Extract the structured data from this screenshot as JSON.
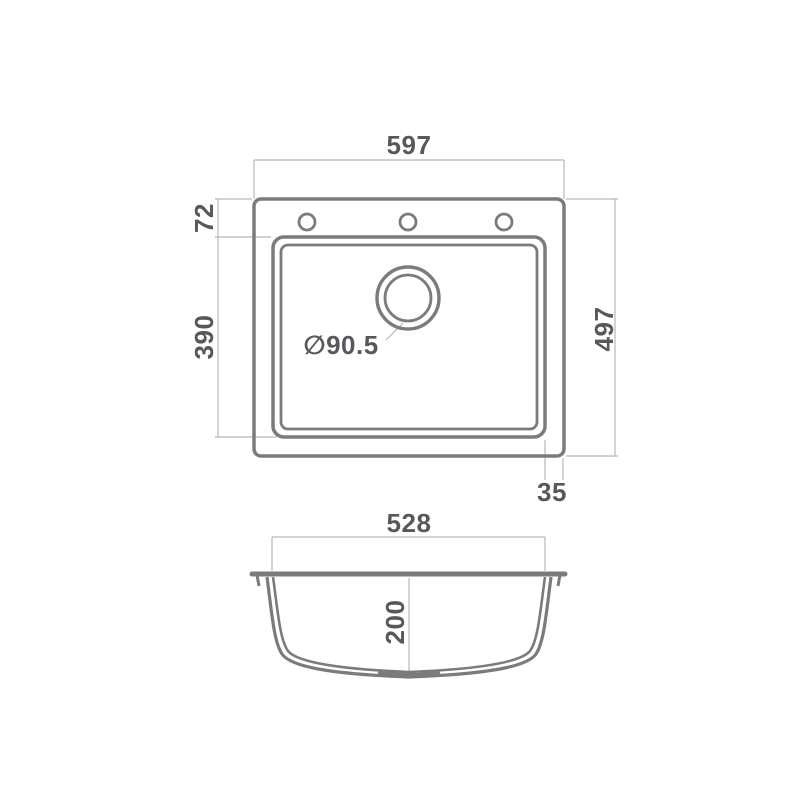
{
  "colors": {
    "outline": "#7a7b7e",
    "dim_line": "#b7b7b9",
    "text": "#57585c",
    "background": "#ffffff"
  },
  "top_view": {
    "overall_width": "597",
    "rim_to_bowl_top": "72",
    "bowl_length": "390",
    "overall_depth": "497",
    "rim_to_bowl_side": "35",
    "drain_diameter": "∅90.5"
  },
  "section_view": {
    "bowl_width": "528",
    "bowl_depth": "200"
  }
}
